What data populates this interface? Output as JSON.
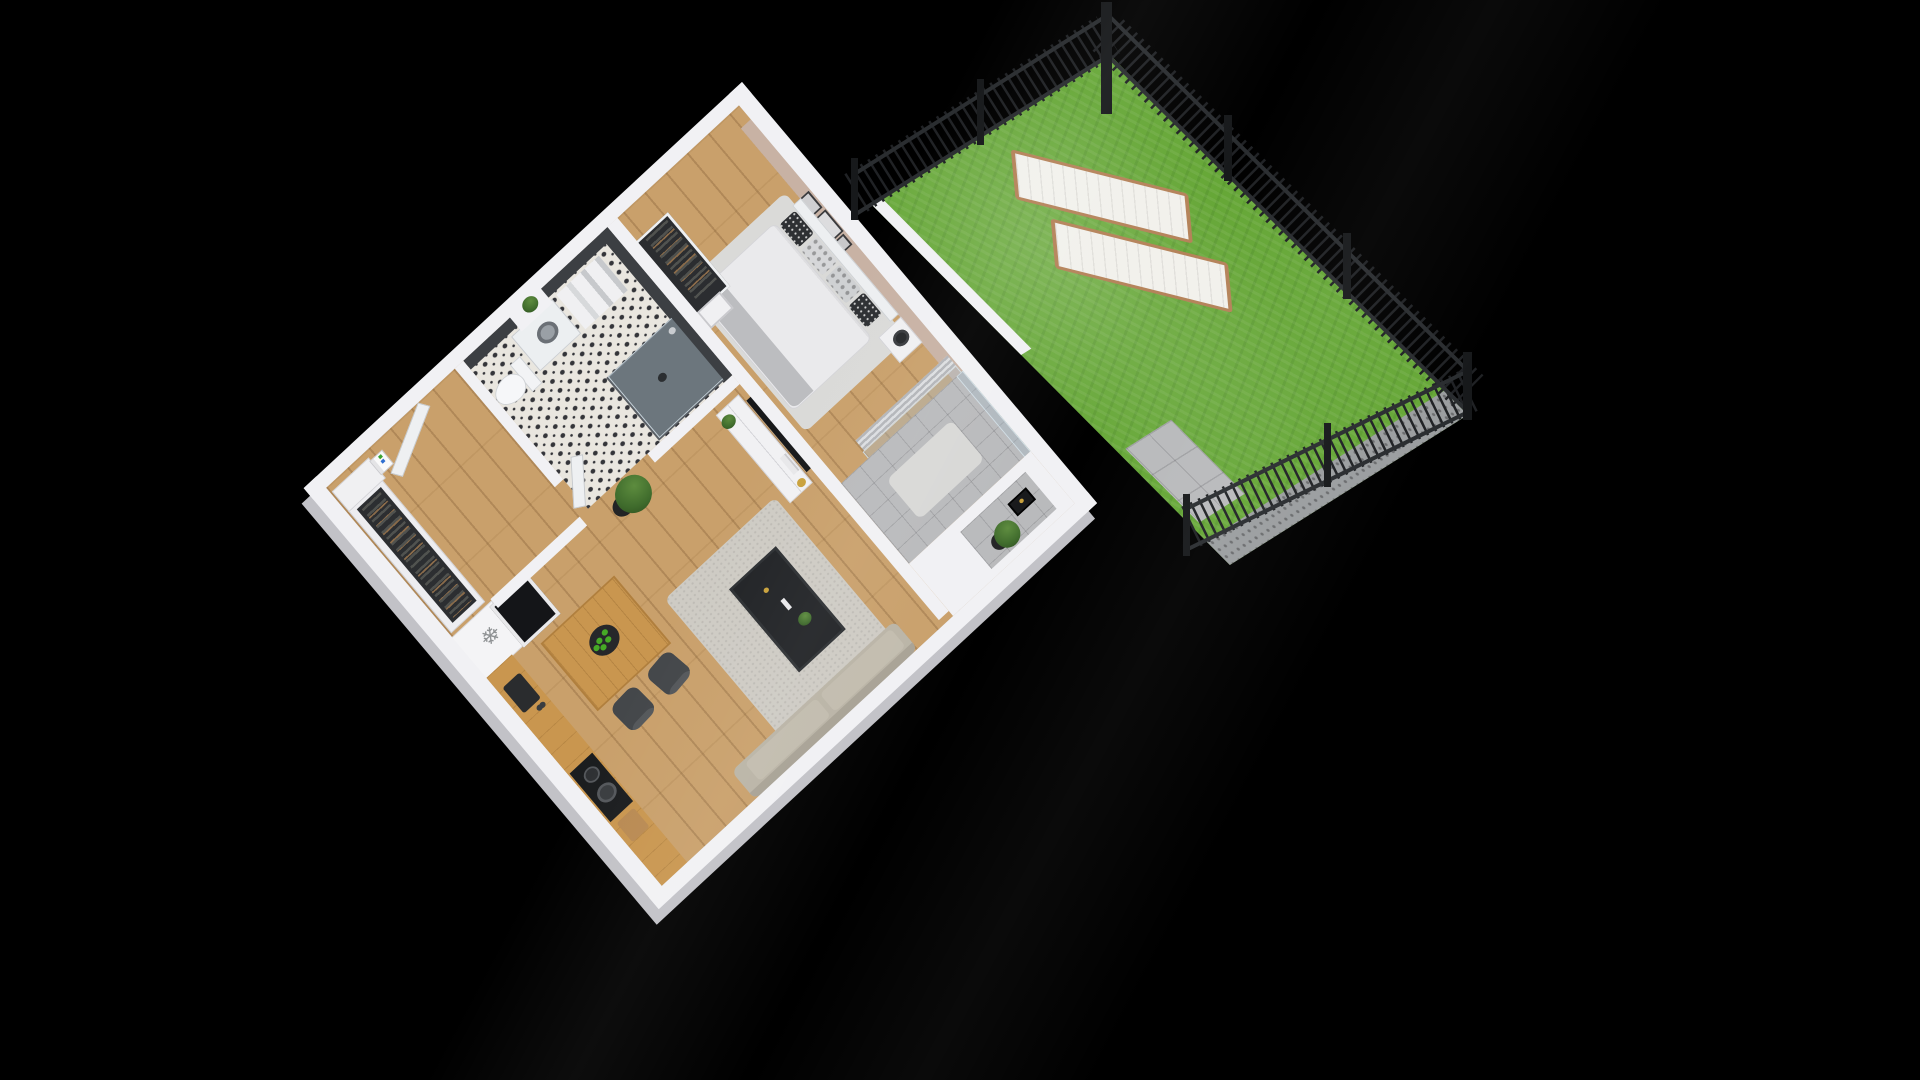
{
  "scene": {
    "type": "isometric-3d-floor-plan-render",
    "description": "3D isometric cutaway render of a studio apartment with a private fenced garden on a black background",
    "background_color": "#000000"
  },
  "icons": {
    "freezer_snowflake": "❄"
  },
  "colors": {
    "background": "#000000",
    "wall_top": "#f1f1f4",
    "wall_face": "#c2c2c7",
    "accent_wall": "#c8b2a4",
    "dark_tile": "#3c3f43",
    "wood_floor": "#c9a06b",
    "tile_floor": "#e9e6df",
    "grass": "#66a737",
    "fence": "#202225",
    "fence_post": "#17191b",
    "lounger": "#f2f1ec",
    "lounger_frame": "#b5835a",
    "sofa": "#bab4a6",
    "rug_living": "#cecbc4",
    "rug_bedroom": "#dadad8",
    "tv_black": "#17181a",
    "table_wood": "#c9964f",
    "chair_gray": "#55585b",
    "apple_green": "#46a926",
    "gold": "#c9a13b",
    "balcony_floor": "#b9babc",
    "plant_green": "#3f6b2c",
    "linen_white": "#eaeaec",
    "blanket_gray": "#bcbdc0"
  },
  "apartment": {
    "rooms": [
      {
        "id": "bedroom",
        "items": [
          "double-bed",
          "headboard",
          "pillows-x4",
          "white-duvet",
          "gray-blanket",
          "area-rug",
          "nightstand",
          "black-table-lamp",
          "wall-art-frames-x3",
          "open-wardrobe-rail",
          "curtains",
          "window-wall"
        ]
      },
      {
        "id": "bathroom",
        "items": [
          "glass-walk-in-shower",
          "toilet",
          "washing-machine",
          "shelf-unit-with-towels",
          "plant",
          "dark-tiled-walls",
          "black-white-patterned-floor",
          "bathroom-door"
        ]
      },
      {
        "id": "hallway",
        "items": [
          "entrance-door",
          "coat-rail-with-clothes",
          "storage-cabinet",
          "stacked-boxes",
          "wood-floor"
        ]
      },
      {
        "id": "living-room",
        "items": [
          "wall-mounted-tv",
          "tv-console",
          "gold-vase",
          "books",
          "potted-plant-large",
          "potted-plant-small",
          "black-coffee-table",
          "coffee-table-plant",
          "remote",
          "candle",
          "gray-rug",
          "sofa"
        ]
      },
      {
        "id": "kitchen",
        "items": [
          "fridge-freezer-with-snowflake",
          "black-freezer-box",
          "wood-countertop",
          "black-sink",
          "faucet",
          "cooktop-with-pot",
          "cutting-board",
          "dining-table",
          "chairs-x2",
          "fruit-bowl-with-green-apples"
        ]
      },
      {
        "id": "balcony",
        "items": [
          "concrete-paver-floor",
          "small-rug",
          "glass-doors",
          "hedge-strip",
          "terrace-wall",
          "black-lantern",
          "potted-plant-on-stand",
          "concrete-pad"
        ]
      }
    ]
  },
  "garden": {
    "items": [
      "lawn",
      "black-metal-picket-fence",
      "fence-posts",
      "sun-lounger-pads-x2",
      "gravel-strip",
      "concrete-paving",
      "low-white-wall"
    ],
    "lounger_count": 2,
    "fence_runs": 3
  }
}
